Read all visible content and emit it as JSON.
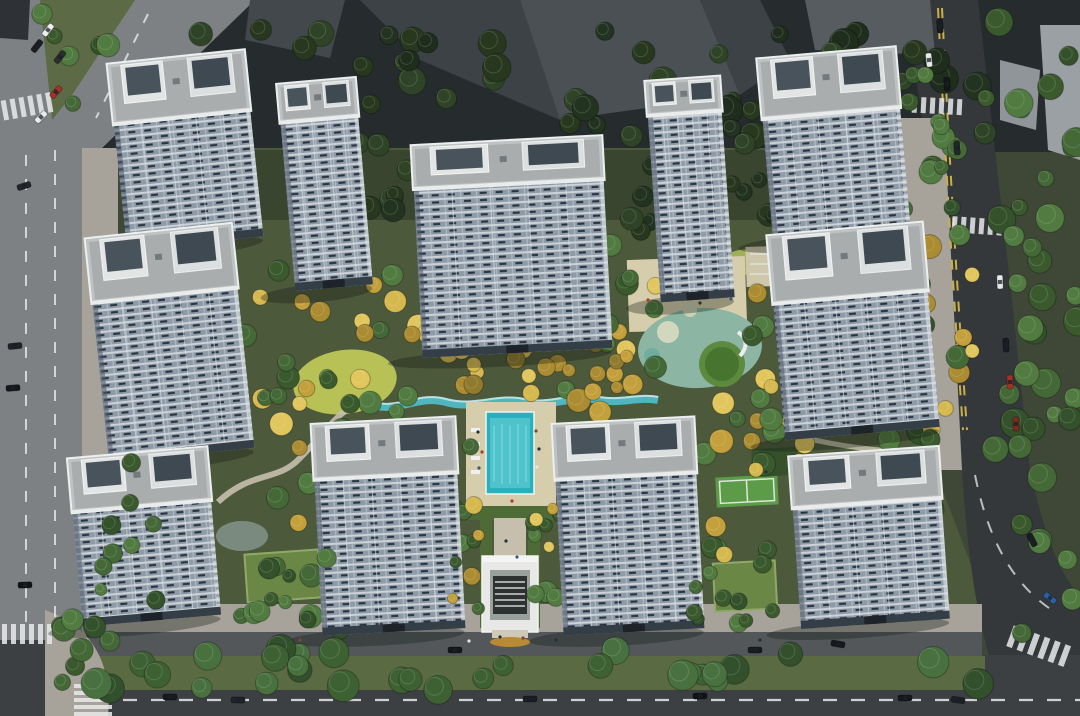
{
  "scene": {
    "type": "aerial-architectural-rendering",
    "subject": "residential-high-rise-complex-with-central-landscaped-garden-and-pool"
  },
  "palette": {
    "site": "#3f4836",
    "garden": "#4d593b",
    "garden_dark": "#39452f",
    "road_left": "#7d8184",
    "road_right": "#34383b",
    "road_main": "#3c4043",
    "sidewalk": "#a7a39a",
    "internal_street": "#53575a",
    "verge": "#5a6a42",
    "median": "#5c6b45",
    "bldg_a": "#42484b",
    "bldg_b": "#3c4245",
    "bldg_c": "#4a5053",
    "bldg_d": "#565c5f",
    "bldg_light": "#9aa0a3",
    "dark_corner": "#2e3236",
    "roof": "#bfc2c3",
    "roof_inner": "#a9adae",
    "facade_glass": "#8d9aa8",
    "facade_slab": "#ccd2d6",
    "facade_dark": "#2a3240",
    "lawn": "#b7c155",
    "lawn2": "#a2b055",
    "sand": "#d6cdad",
    "deck": "#cfc7ab",
    "pool": "#2ab0bd",
    "pool_light": "#55c7cf",
    "stream": "#4fb6bf",
    "hedge": "#4e6a37",
    "path": "#c6bfae",
    "green_roof": "#6b8746",
    "pavilion": "#35502b",
    "court": "#5c9c48",
    "pond": "#7a8a7e",
    "gate_white": "#e8e9e7",
    "gate_dark": "#2e3331",
    "marking": "#e8eaea",
    "marking_yellow": "#c9b04a",
    "shadow": "#10150f",
    "play_base": "#8cb5a4",
    "play_green": "#47742f",
    "play_ring": "#5d8a3f"
  },
  "towers": [
    {
      "id": "t1",
      "x": 116,
      "y": 56,
      "w": 139,
      "rh": 62,
      "fh": 126,
      "rot": -6
    },
    {
      "id": "t2",
      "x": 285,
      "y": 80,
      "w": 80,
      "rh": 40,
      "fh": 168,
      "rot": -5
    },
    {
      "id": "t3",
      "x": 416,
      "y": 140,
      "w": 192,
      "rh": 45,
      "fh": 168,
      "rot": -3
    },
    {
      "id": "t4",
      "x": 652,
      "y": 78,
      "w": 76,
      "rh": 36,
      "fh": 186,
      "rot": -4
    },
    {
      "id": "t5",
      "x": 764,
      "y": 52,
      "w": 140,
      "rh": 62,
      "fh": 122,
      "rot": -5
    },
    {
      "id": "t6",
      "x": 96,
      "y": 230,
      "w": 148,
      "rh": 66,
      "fh": 160,
      "rot": -6
    },
    {
      "id": "t7",
      "x": 775,
      "y": 228,
      "w": 157,
      "rh": 70,
      "fh": 136,
      "rot": -5
    },
    {
      "id": "t8",
      "x": 74,
      "y": 452,
      "w": 141,
      "rh": 55,
      "fh": 114,
      "rot": -5
    },
    {
      "id": "t9",
      "x": 316,
      "y": 420,
      "w": 145,
      "rh": 57,
      "fh": 155,
      "rot": -3
    },
    {
      "id": "t10",
      "x": 557,
      "y": 420,
      "w": 143,
      "rh": 57,
      "fh": 155,
      "rot": -3
    },
    {
      "id": "t11",
      "x": 794,
      "y": 451,
      "w": 151,
      "rh": 53,
      "fh": 120,
      "rot": -4
    }
  ],
  "tree_palettes": {
    "dark": [
      "#1f2d1c",
      "#27381f",
      "#2f4426",
      "#223320"
    ],
    "mid": [
      "#3a5a2e",
      "#446937",
      "#517b40",
      "#33512a"
    ],
    "yellow": [
      "#c3a03c",
      "#d5b84e",
      "#ab8c32",
      "#e0c65c",
      "#8f7a2e"
    ],
    "street": [
      "#33502c",
      "#3e6134",
      "#497140"
    ],
    "mixed": [
      "#c3a03c",
      "#446937",
      "#d5b84e",
      "#517b40",
      "#ab8c32",
      "#3a5a2e",
      "#e0c65c"
    ]
  },
  "tree_clusters": [
    {
      "x": 170,
      "y": 28,
      "w": 820,
      "h": 118,
      "n": 50,
      "p": "dark",
      "r0": 8,
      "r1": 15,
      "front": false
    },
    {
      "x": 40,
      "y": 4,
      "w": 100,
      "h": 118,
      "n": 9,
      "p": "mid",
      "r0": 7,
      "r1": 12,
      "front": false
    },
    {
      "x": 150,
      "y": 118,
      "w": 90,
      "h": 115,
      "n": 10,
      "p": "dark",
      "r0": 7,
      "r1": 12,
      "front": false
    },
    {
      "x": 355,
      "y": 118,
      "w": 70,
      "h": 95,
      "n": 8,
      "p": "dark",
      "r0": 7,
      "r1": 12,
      "front": false
    },
    {
      "x": 615,
      "y": 130,
      "w": 90,
      "h": 105,
      "n": 10,
      "p": "dark",
      "r0": 7,
      "r1": 12,
      "front": false
    },
    {
      "x": 725,
      "y": 115,
      "w": 70,
      "h": 110,
      "n": 8,
      "p": "dark",
      "r0": 7,
      "r1": 12,
      "front": false
    },
    {
      "x": 108,
      "y": 228,
      "w": 78,
      "h": 300,
      "n": 16,
      "p": "mid",
      "r0": 7,
      "r1": 13,
      "front": false
    },
    {
      "x": 100,
      "y": 455,
      "w": 62,
      "h": 190,
      "n": 10,
      "p": "mid",
      "r0": 6,
      "r1": 11,
      "front": true
    },
    {
      "x": 848,
      "y": 75,
      "w": 85,
      "h": 535,
      "n": 26,
      "p": "mid",
      "r0": 8,
      "r1": 14,
      "front": false
    },
    {
      "x": 982,
      "y": 0,
      "w": 98,
      "h": 635,
      "n": 38,
      "p": "mid",
      "r0": 8,
      "r1": 15,
      "front": false
    },
    {
      "x": 95,
      "y": 648,
      "w": 905,
      "h": 42,
      "n": 30,
      "p": "street",
      "r0": 10,
      "r1": 16,
      "front": true
    },
    {
      "x": 225,
      "y": 262,
      "w": 210,
      "h": 148,
      "n": 24,
      "p": "mixed",
      "r0": 7,
      "r1": 12,
      "front": false
    },
    {
      "x": 552,
      "y": 232,
      "w": 118,
      "h": 188,
      "n": 18,
      "p": "mixed",
      "r0": 7,
      "r1": 12,
      "front": false
    },
    {
      "x": 742,
      "y": 282,
      "w": 78,
      "h": 188,
      "n": 15,
      "p": "mixed",
      "r0": 7,
      "r1": 12,
      "front": false
    },
    {
      "x": 248,
      "y": 392,
      "w": 228,
      "h": 168,
      "n": 24,
      "p": "mixed",
      "r0": 7,
      "r1": 12,
      "front": false
    },
    {
      "x": 420,
      "y": 342,
      "w": 225,
      "h": 62,
      "n": 18,
      "p": "yellow",
      "r0": 6,
      "r1": 10,
      "front": false
    },
    {
      "x": 452,
      "y": 498,
      "w": 36,
      "h": 130,
      "n": 7,
      "p": "mixed",
      "r0": 5,
      "r1": 9,
      "front": true
    },
    {
      "x": 532,
      "y": 498,
      "w": 36,
      "h": 130,
      "n": 7,
      "p": "mixed",
      "r0": 5,
      "r1": 9,
      "front": true
    },
    {
      "x": 298,
      "y": 468,
      "w": 72,
      "h": 162,
      "n": 10,
      "p": "mid",
      "r0": 7,
      "r1": 12,
      "front": false
    },
    {
      "x": 545,
      "y": 468,
      "w": 62,
      "h": 162,
      "n": 10,
      "p": "mid",
      "r0": 7,
      "r1": 12,
      "front": false
    },
    {
      "x": 700,
      "y": 398,
      "w": 102,
      "h": 162,
      "n": 16,
      "p": "mixed",
      "r0": 7,
      "r1": 12,
      "front": false
    },
    {
      "x": 925,
      "y": 225,
      "w": 55,
      "h": 245,
      "n": 11,
      "p": "mixed",
      "r0": 7,
      "r1": 12,
      "front": false
    },
    {
      "x": 238,
      "y": 556,
      "w": 92,
      "h": 68,
      "n": 10,
      "p": "mid",
      "r0": 6,
      "r1": 11,
      "front": true
    },
    {
      "x": 688,
      "y": 556,
      "w": 92,
      "h": 68,
      "n": 10,
      "p": "mid",
      "r0": 6,
      "r1": 11,
      "front": true
    },
    {
      "x": 905,
      "y": 118,
      "w": 58,
      "h": 118,
      "n": 8,
      "p": "mid",
      "r0": 7,
      "r1": 12,
      "front": false
    },
    {
      "x": 55,
      "y": 615,
      "w": 55,
      "h": 85,
      "n": 7,
      "p": "mid",
      "r0": 8,
      "r1": 13,
      "front": true
    }
  ],
  "cars": [
    {
      "x": 48,
      "y": 30,
      "a": -52,
      "c": "#eef0f0"
    },
    {
      "x": 37,
      "y": 46,
      "a": -52,
      "c": "#1c1f22"
    },
    {
      "x": 60,
      "y": 57,
      "a": -52,
      "c": "#2a2e31"
    },
    {
      "x": 56,
      "y": 92,
      "a": -48,
      "c": "#a3322a"
    },
    {
      "x": 41,
      "y": 117,
      "a": -45,
      "c": "#e9ebeb"
    },
    {
      "x": 24,
      "y": 186,
      "a": -18,
      "c": "#22262a"
    },
    {
      "x": 15,
      "y": 346,
      "a": -6,
      "c": "#1e2226"
    },
    {
      "x": 13,
      "y": 388,
      "a": -4,
      "c": "#15181b"
    },
    {
      "x": 25,
      "y": 585,
      "a": -2,
      "c": "#111417"
    },
    {
      "x": 940,
      "y": 26,
      "a": 86,
      "c": "#191d20"
    },
    {
      "x": 929,
      "y": 60,
      "a": 84,
      "c": "#e8eaea"
    },
    {
      "x": 947,
      "y": 84,
      "a": 86,
      "c": "#14181b"
    },
    {
      "x": 957,
      "y": 148,
      "a": 86,
      "c": "#23272b"
    },
    {
      "x": 1000,
      "y": 282,
      "a": 88,
      "c": "#e6e8e8"
    },
    {
      "x": 1006,
      "y": 345,
      "a": 88,
      "c": "#191d21"
    },
    {
      "x": 1010,
      "y": 382,
      "a": 88,
      "c": "#a33127"
    },
    {
      "x": 1016,
      "y": 424,
      "a": 89,
      "c": "#7e2a20"
    },
    {
      "x": 1032,
      "y": 540,
      "a": 62,
      "c": "#1a1e22"
    },
    {
      "x": 1050,
      "y": 598,
      "a": 38,
      "c": "#2f5f9e"
    },
    {
      "x": 170,
      "y": 697,
      "a": 0,
      "c": "#17191c"
    },
    {
      "x": 238,
      "y": 700,
      "a": 2,
      "c": "#202428"
    },
    {
      "x": 455,
      "y": 650,
      "a": 0,
      "c": "#15181a"
    },
    {
      "x": 530,
      "y": 699,
      "a": 0,
      "c": "#1b1f23"
    },
    {
      "x": 700,
      "y": 696,
      "a": -2,
      "c": "#111416"
    },
    {
      "x": 755,
      "y": 650,
      "a": 0,
      "c": "#181c1f"
    },
    {
      "x": 838,
      "y": 644,
      "a": 10,
      "c": "#16191c"
    },
    {
      "x": 905,
      "y": 698,
      "a": 0,
      "c": "#15181b"
    },
    {
      "x": 958,
      "y": 700,
      "a": 8,
      "c": "#1d2125"
    }
  ],
  "crosswalks": [
    {
      "x": 2,
      "y": 96,
      "n": 6,
      "sw": 5,
      "sh": 20,
      "gap": 9,
      "dir": "v",
      "rot": -10
    },
    {
      "x": 2,
      "y": 624,
      "n": 6,
      "sw": 5,
      "sh": 20,
      "gap": 9,
      "dir": "v",
      "rot": 0
    },
    {
      "x": 74,
      "y": 684,
      "n": 5,
      "sw": 38,
      "sh": 4,
      "gap": 7,
      "dir": "h",
      "rot": 0
    },
    {
      "x": 952,
      "y": 218,
      "n": 6,
      "sw": 5,
      "sh": 16,
      "gap": 9,
      "dir": "v",
      "rot": 4
    },
    {
      "x": 912,
      "y": 98,
      "n": 6,
      "sw": 5,
      "sh": 16,
      "gap": 9,
      "dir": "v",
      "rot": 3
    },
    {
      "x": 1008,
      "y": 636,
      "n": 6,
      "sw": 6,
      "sh": 22,
      "gap": 11,
      "dir": "v",
      "rot": 20
    }
  ],
  "figures": [
    {
      "x": 478,
      "y": 432,
      "c": "#20323a"
    },
    {
      "x": 482,
      "y": 452,
      "c": "#aa3b2d"
    },
    {
      "x": 479,
      "y": 468,
      "c": "#3a5a7a"
    },
    {
      "x": 536,
      "y": 431,
      "c": "#7a4a2e"
    },
    {
      "x": 539,
      "y": 449,
      "c": "#20323a"
    },
    {
      "x": 537,
      "y": 467,
      "c": "#e4e6e4"
    },
    {
      "x": 512,
      "y": 501,
      "c": "#aa3b2d"
    },
    {
      "x": 506,
      "y": 541,
      "c": "#20323a"
    },
    {
      "x": 517,
      "y": 557,
      "c": "#3a5a7a"
    },
    {
      "x": 500,
      "y": 637,
      "c": "#20323a"
    },
    {
      "x": 523,
      "y": 638,
      "c": "#7a4a2e"
    },
    {
      "x": 469,
      "y": 641,
      "c": "#e4e6e4"
    },
    {
      "x": 556,
      "y": 640,
      "c": "#20323a"
    },
    {
      "x": 648,
      "y": 300,
      "c": "#aa3b2d"
    },
    {
      "x": 700,
      "y": 303,
      "c": "#20323a"
    },
    {
      "x": 731,
      "y": 299,
      "c": "#3a5a7a"
    },
    {
      "x": 766,
      "y": 472,
      "c": "#20323a"
    },
    {
      "x": 300,
      "y": 640,
      "c": "#7a4a2e"
    },
    {
      "x": 760,
      "y": 640,
      "c": "#20323a"
    }
  ]
}
